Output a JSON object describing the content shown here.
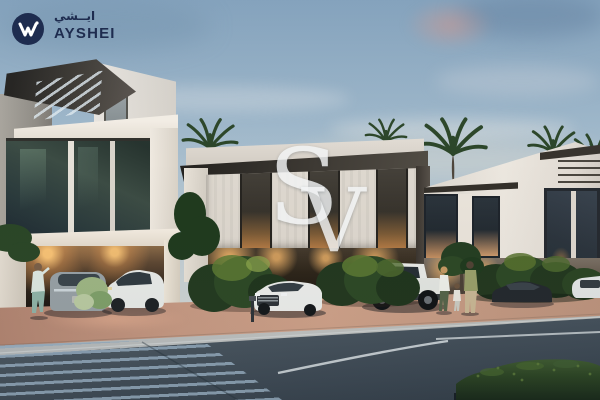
{
  "brand": {
    "icon": "w-monogram-icon",
    "name_arabic": "ايــشي",
    "name": "AYSHEI"
  },
  "watermark": {
    "letter_s": "S",
    "letter_v": "V"
  },
  "scene": {
    "type": "architectural-exterior-render",
    "time_of_day": "dusk",
    "subject": "Modern white two-storey townhouse row with slatted roof canopy, glass facades and warm interior lighting; palm trees behind; parked cars (grey fastback, white crossover, white SUV, white pickup truck, dark coupe, white car); a woman by the carport and a family of three on the sidewalk; terracotta driveway, grey sidewalk and dark asphalt road with striped crosswalk in the foreground",
    "colors": {
      "navy": "#1e2c4f",
      "sky-top": "#84a2bc",
      "sky-mid": "#bccbd4",
      "sky-low": "#d2d7d6",
      "cloud-pink": "#d09a8e",
      "wall": "#e9e5df",
      "wall-shade": "#cfc9c0",
      "roof": "#3e3a34",
      "glass": "#2c3a3c",
      "warm-light": "#f0b269",
      "terracotta": "#c79a84",
      "sidewalk": "#b8bcbe",
      "road": "#42505c",
      "crosswalk-stripe": "#94acc0",
      "lane-line": "#e8eef2",
      "hedge": "#24391f",
      "bush": "#2c4826",
      "bush-light": "#6f8a3e",
      "palm": "#2c4629",
      "car-white": "#e9ebe8",
      "car-gray": "#97a1a6",
      "car-dark": "#23282e",
      "watermark-white": "#f3f5f6"
    }
  }
}
